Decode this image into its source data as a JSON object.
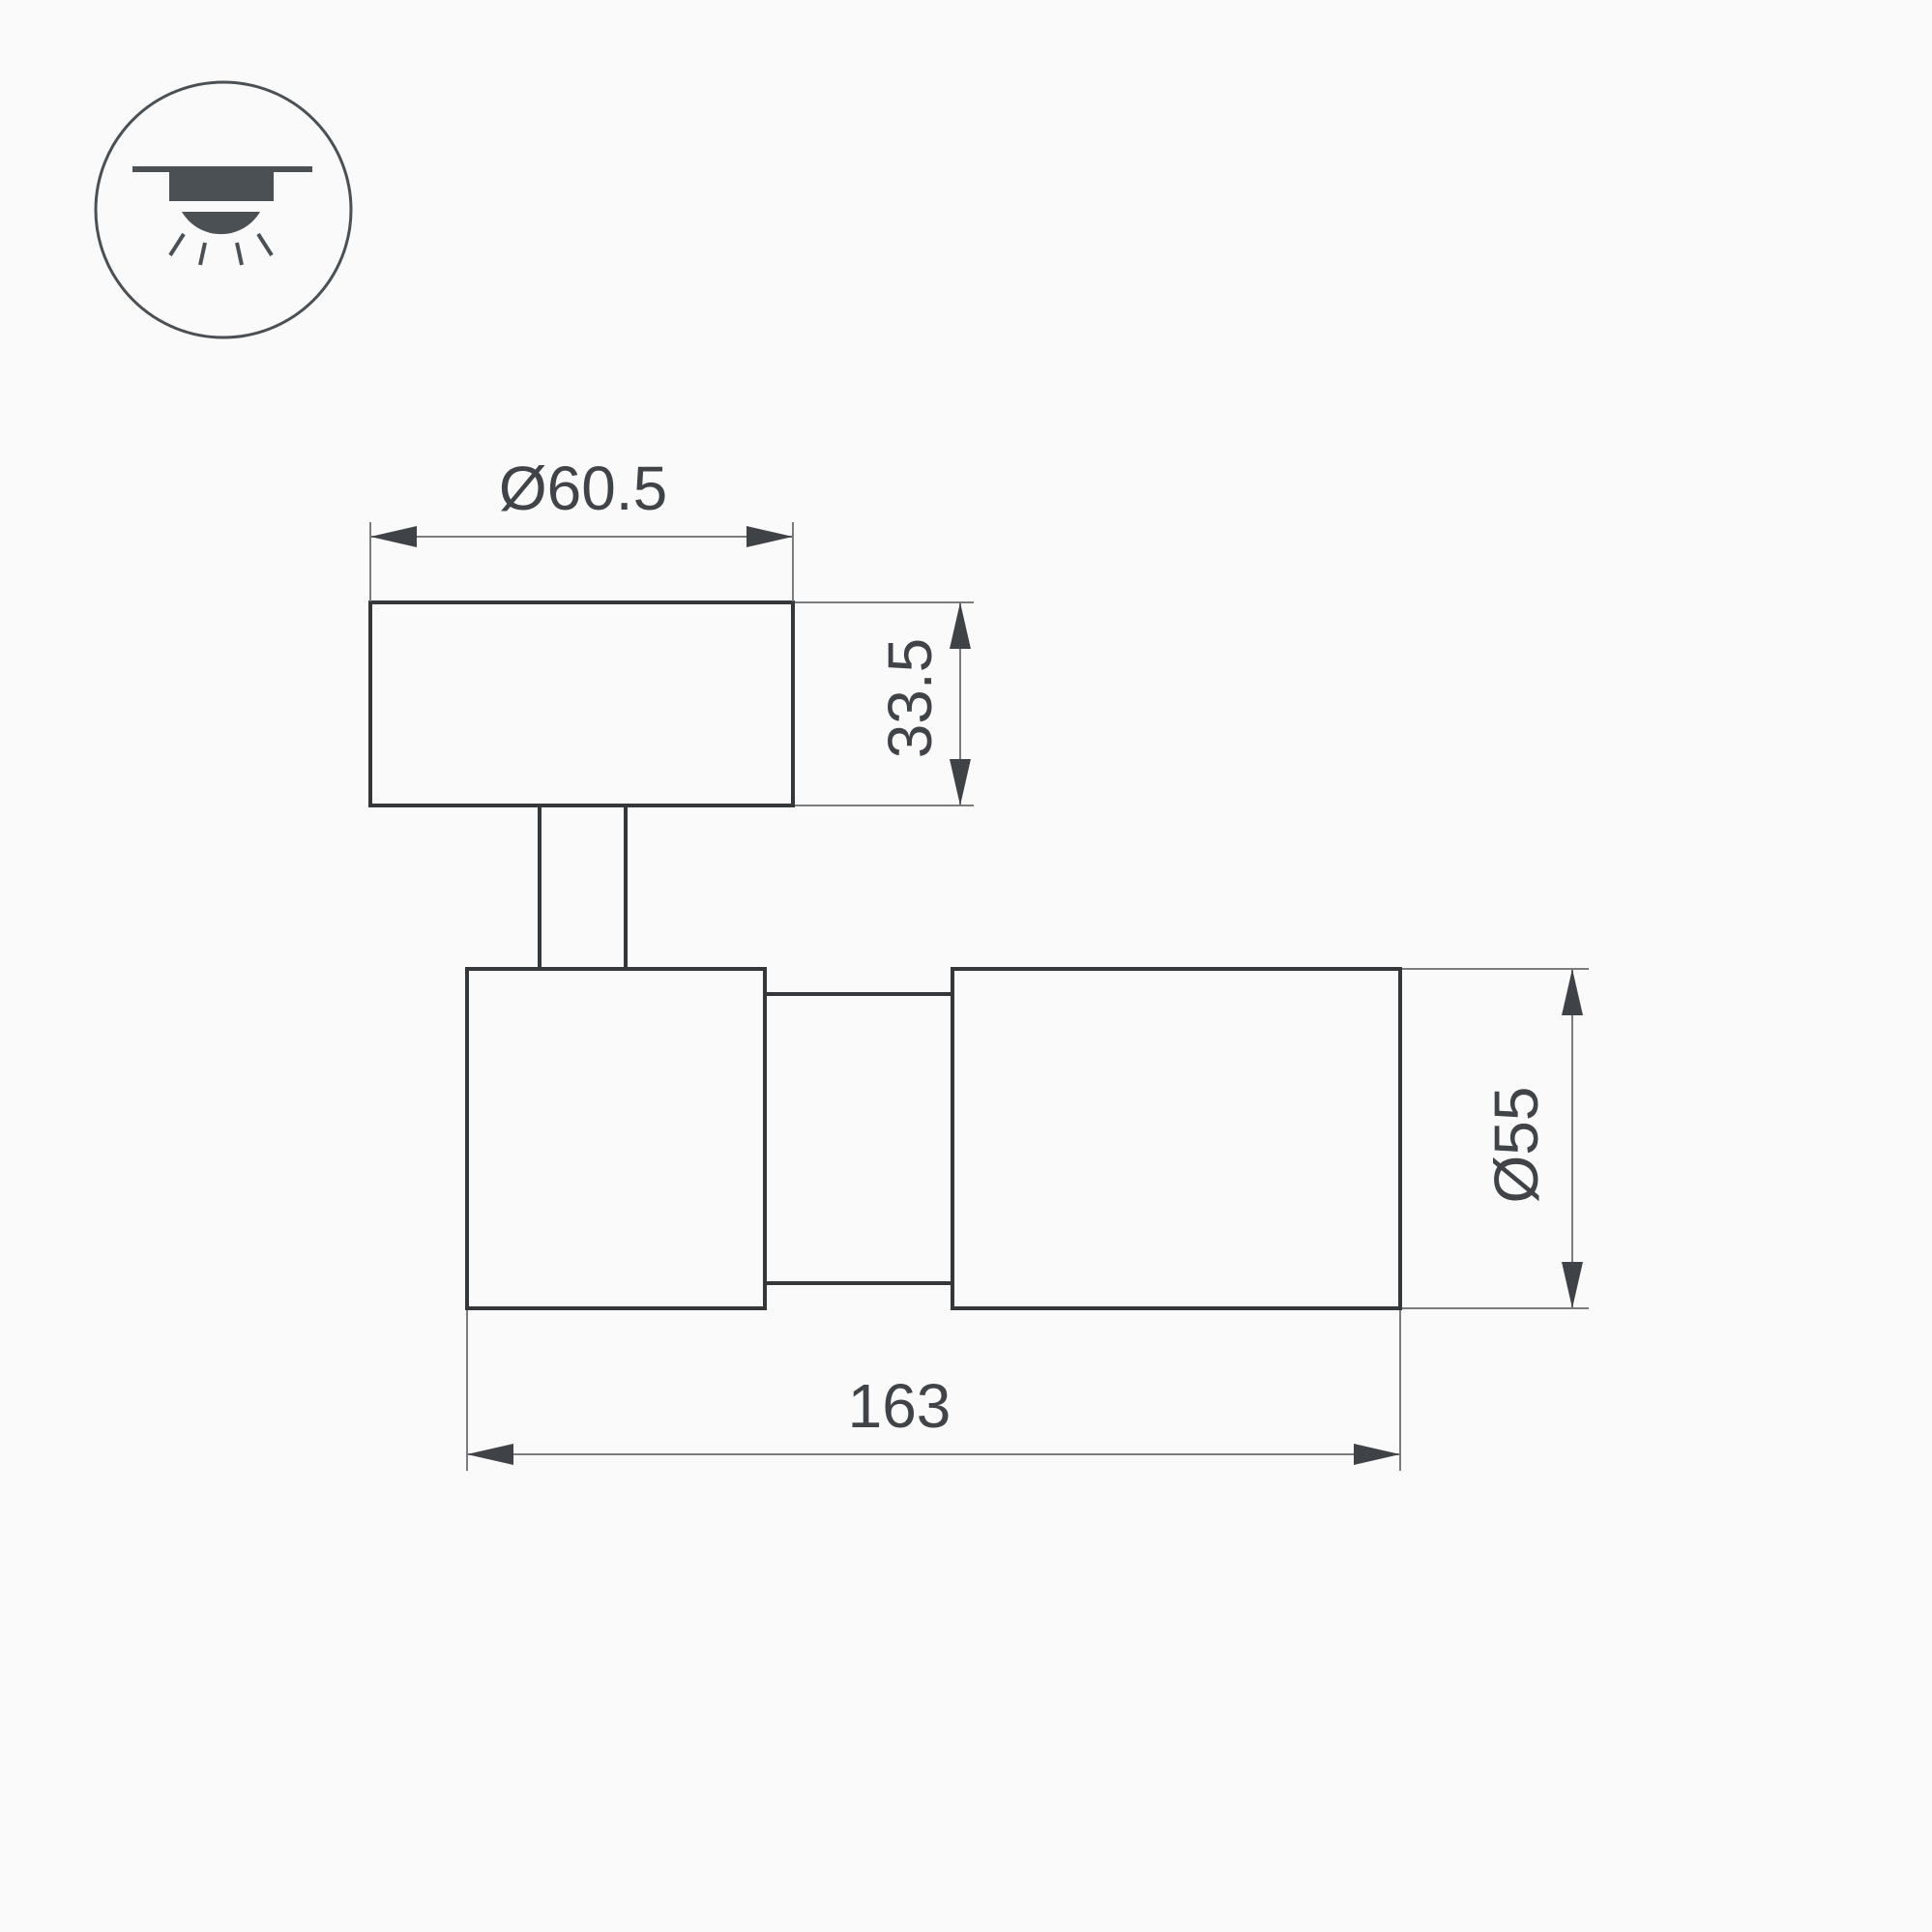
{
  "icon": {
    "name": "ceiling-mount-light-icon"
  },
  "dimensions": {
    "mount_diameter": {
      "label": "Ø60.5"
    },
    "mount_height": {
      "label": "33.5"
    },
    "body_diameter": {
      "label": "Ø55"
    },
    "body_length": {
      "label": "163"
    }
  },
  "colors": {
    "background": "#fafafa",
    "outline": "#35383b",
    "dim_line": "#7a7c7e",
    "arrow": "#3f4347",
    "text": "#404448",
    "icon": "#4a5054"
  }
}
